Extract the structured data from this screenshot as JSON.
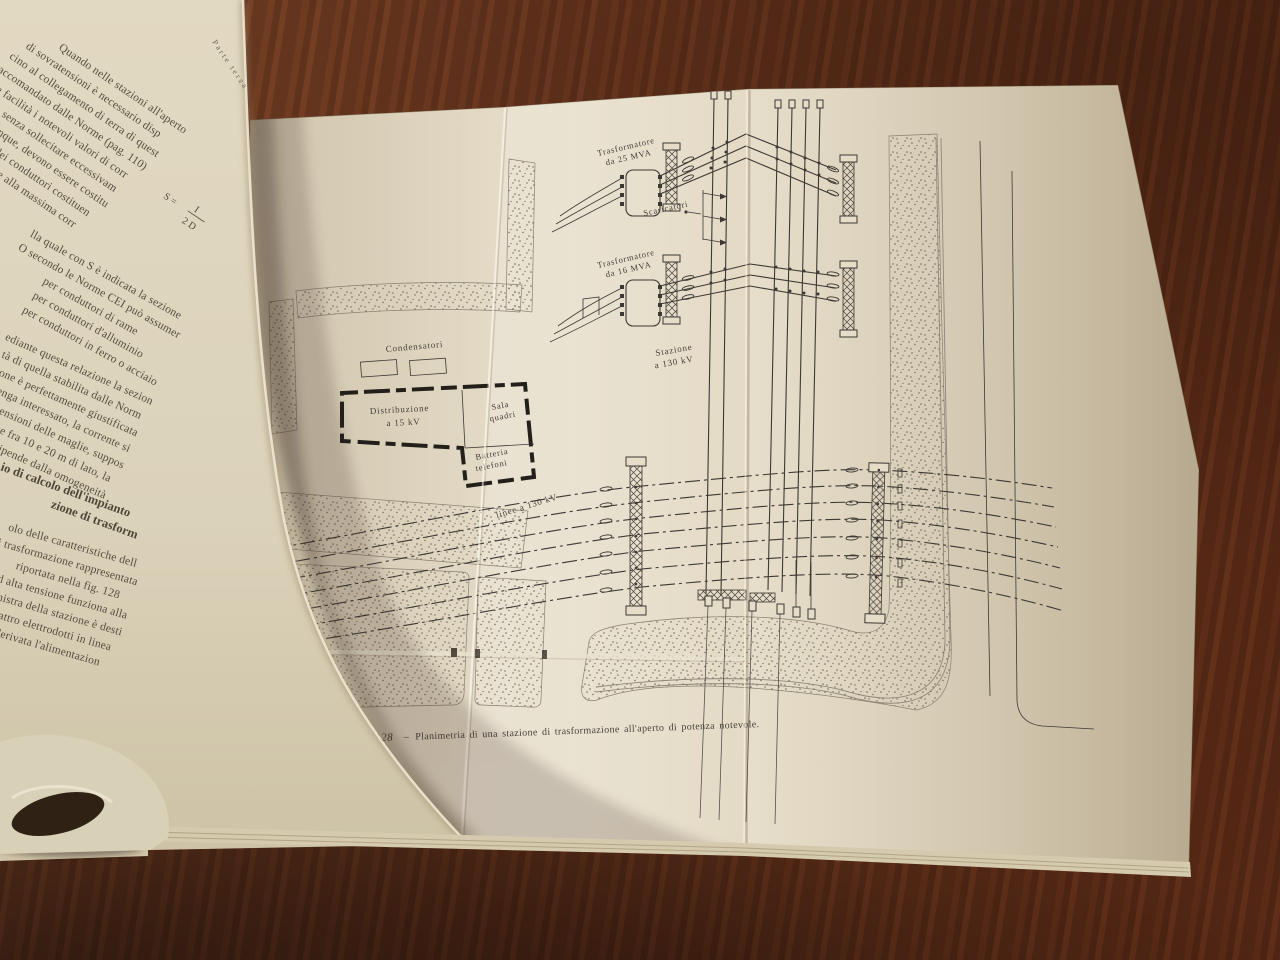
{
  "colors": {
    "paper": "#e4dbc6",
    "ink": "#3c3833",
    "wood": "#6e3820"
  },
  "left_page": {
    "running_head": "Parte terza",
    "para1": [
      "Quando nelle stazioni all'aperto",
      "di sovratensioni è necessario disp",
      "cino al collegamento di terra di quest",
      "raccomandato dalle Norme (pag. 110)",
      "giore facilità i notevoli valori di corr",
      "sferiche, senza sollecitare eccessivam",
      "quali, comunque, devono essere costitu",
      "La sezione dei conduttori costituen",
      "sere valutata in base alla massima corr",
      "a relazione:"
    ],
    "formula": {
      "lhs": "S =",
      "num": "I",
      "den": "2 D"
    },
    "para2": [
      "lla quale con S è indicata la sezione",
      "O secondo le Norme CEI può assumer",
      "per conduttori di rame",
      "per conduttori d'alluminio",
      "per conduttori in ferro o acciaio"
    ],
    "para3": [
      "ediante questa relazione la sezion",
      "tà di quella stabilita dalle Norm",
      "zione è perfettamente giustificata",
      "venga interessato, la corrente si",
      "dimensioni delle maglie, suppos",
      "omprese fra 10 e 20 m di lato, la",
      "sposti dipende dalla omogeneità"
    ],
    "heading": [
      "io di calcolo dell'impianto",
      "zione di trasform"
    ],
    "para4": [
      "olo delle caratteristiche dell",
      "i trasformazione rappresentata",
      "riportata nella fig. 128",
      "a ad alta tensione funziona alla",
      "e sinistra della stazione è desti",
      "n quattro elettrodotti in linea",
      "ma è derivata l'alimentazion"
    ]
  },
  "diagram": {
    "labels": {
      "transformer1": [
        "Trasformatore",
        "da 25 MVA"
      ],
      "transformer2": [
        "Trasformatore",
        "da 16 MVA"
      ],
      "scaricatori": "Scaricatori",
      "stazione": [
        "Stazione",
        "a 130 kV"
      ],
      "condensatori": "Condensatori",
      "distribuzione": [
        "Distribuzione",
        "a 15 kV"
      ],
      "sala_quadri": [
        "Sala",
        "quadri"
      ],
      "batteria_telefoni": [
        "Batteria",
        "telefoni"
      ],
      "linee": "linee a 130 kV"
    }
  },
  "caption": {
    "fig": "Fig. 128",
    "sep": "–",
    "text": "Planimetria di una stazione di trasformazione all'aperto di potenza notevole."
  }
}
